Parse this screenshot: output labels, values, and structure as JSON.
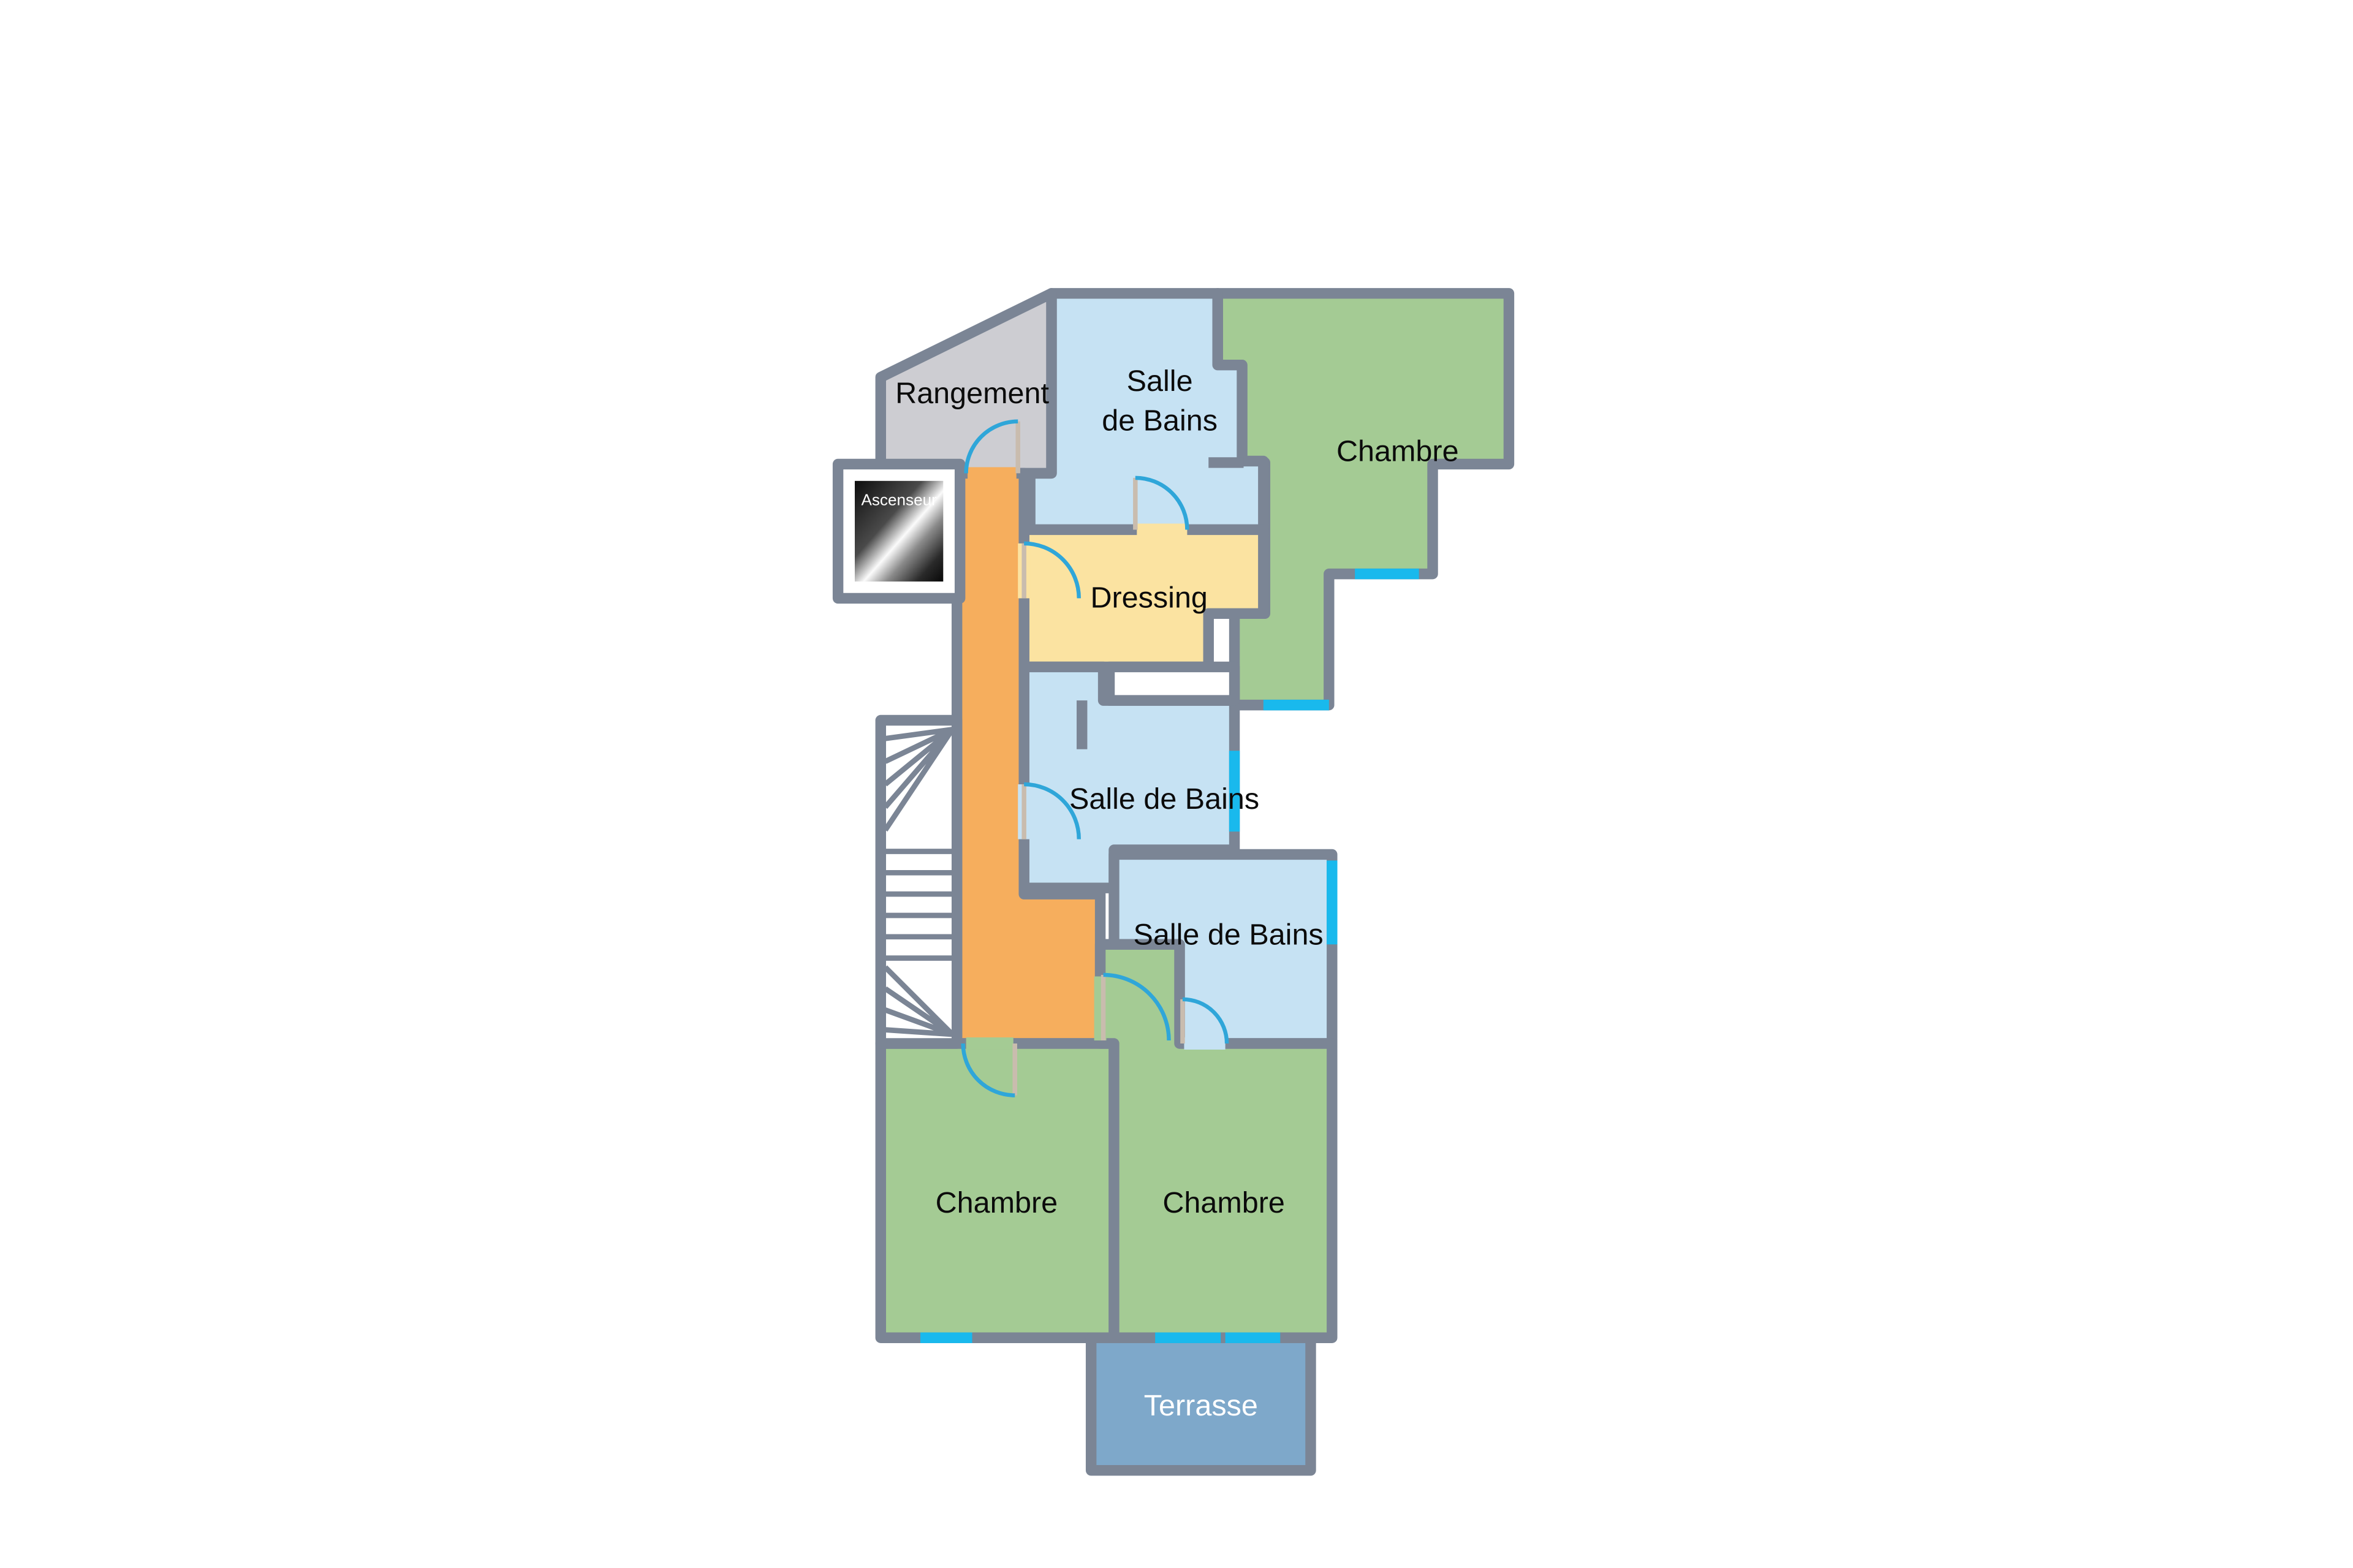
{
  "floorplan": {
    "type": "apartment-floor-plan",
    "language": "fr",
    "rooms": {
      "rangement": {
        "label": "Rangement",
        "color": "#CDCDD2"
      },
      "salle_de_bains_haut": {
        "label_line1": "Salle",
        "label_line2": "de Bains",
        "color": "#C6E2F3"
      },
      "chambre_haut": {
        "label": "Chambre",
        "color": "#A4CB94"
      },
      "ascenseur": {
        "label": "Ascenseur",
        "color": "#111111"
      },
      "dressing": {
        "label": "Dressing",
        "color": "#FBE3A1"
      },
      "salle_de_bains_milieu": {
        "label": "Salle de Bains",
        "color": "#C6E2F3"
      },
      "salle_de_bains_bas": {
        "label": "Salle de Bains",
        "color": "#C6E2F3"
      },
      "chambre_gauche": {
        "label": "Chambre",
        "color": "#A4CB94"
      },
      "chambre_droite": {
        "label": "Chambre",
        "color": "#A4CB94"
      },
      "terrasse": {
        "label": "Terrasse",
        "color": "#7EA8CA"
      }
    },
    "features": {
      "staircase": "winder-staircase",
      "corridor_color": "#F6AE5D",
      "door_count": 7,
      "window_count": 7
    },
    "colors": {
      "wall": "#7B8595",
      "window_marker": "#19B9ED",
      "door_arc": "#2FA6D9",
      "background": "#ffffff"
    }
  }
}
